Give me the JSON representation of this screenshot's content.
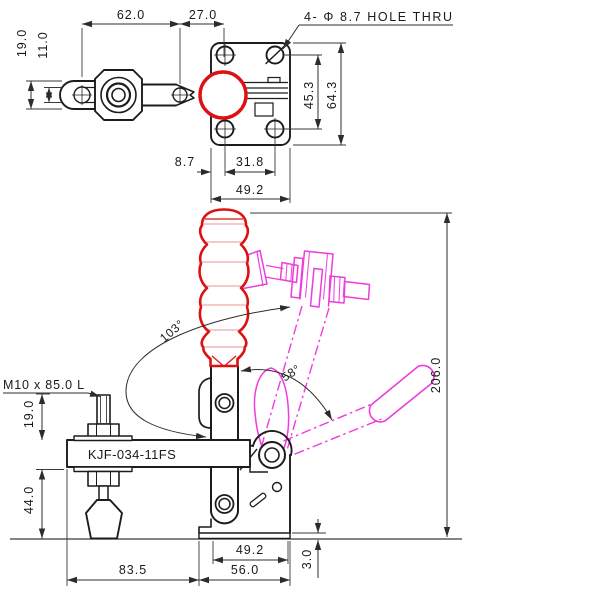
{
  "drawing": {
    "top_view": {
      "note": "4- Φ 8.7 HOLE THRU",
      "dims": {
        "arm_span": "62.0",
        "handle_offset": "27.0",
        "arm_height": "19.0",
        "slot_height": "11.0",
        "hole_spacing_v": "45.3",
        "plate_height": "64.3",
        "edge_to_hole": "8.7",
        "hole_spacing_h": "31.8",
        "plate_width": "49.2"
      }
    },
    "front_view": {
      "model_label": "KJF-034-11FS",
      "spindle_note": "M10 x 85.0 L",
      "dims": {
        "bar_open_angle": "103°",
        "handle_open_angle": "58°",
        "total_height": "206.0",
        "spindle_height": "19.0",
        "bar_to_base": "44.0",
        "base_width": "49.2",
        "foot_width": "56.0",
        "bar_reach": "83.5",
        "base_thickness": "3.0"
      }
    },
    "colors": {
      "line": "#1c1c1c",
      "handle_closed": "#dd1111",
      "phantom_open": "#ee3cdd"
    }
  }
}
